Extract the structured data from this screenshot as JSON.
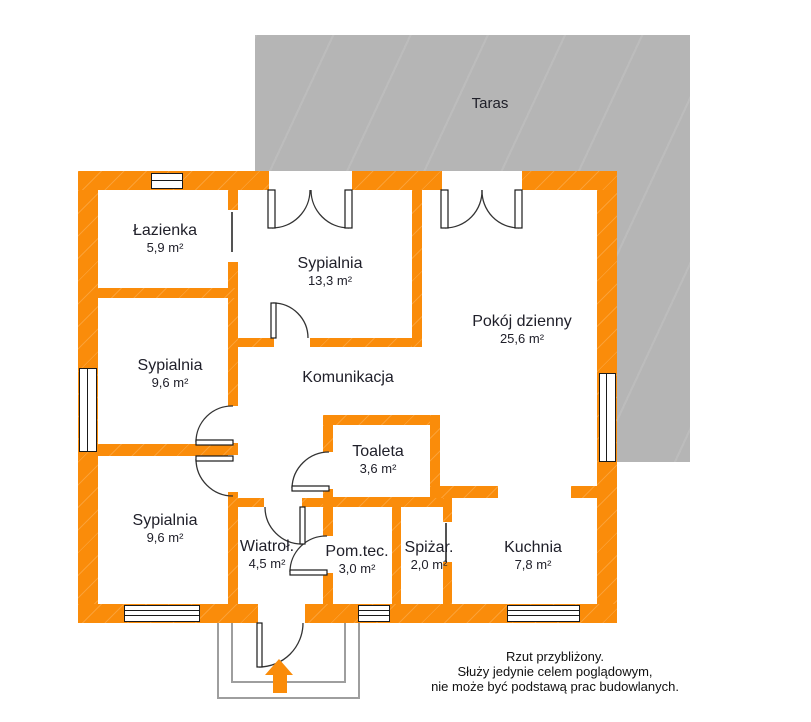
{
  "terrace": {
    "label": "Taras"
  },
  "rooms": [
    {
      "id": "lazienka",
      "name": "Łazienka",
      "area": "5,9 m²",
      "x": 165,
      "y": 222
    },
    {
      "id": "sypialnia-1",
      "name": "Sypialnia",
      "area": "13,3 m²",
      "x": 330,
      "y": 255
    },
    {
      "id": "pokoj-dzienny",
      "name": "Pokój dzienny",
      "area": "25,6 m²",
      "x": 522,
      "y": 313
    },
    {
      "id": "sypialnia-2",
      "name": "Sypialnia",
      "area": "9,6 m²",
      "x": 170,
      "y": 357
    },
    {
      "id": "komunikacja",
      "name": "Komunikacja",
      "area": "",
      "x": 348,
      "y": 369
    },
    {
      "id": "toaleta",
      "name": "Toaleta",
      "area": "3,6 m²",
      "x": 378,
      "y": 443
    },
    {
      "id": "sypialnia-3",
      "name": "Sypialnia",
      "area": "9,6 m²",
      "x": 165,
      "y": 512
    },
    {
      "id": "wiatrolap",
      "name": "Wiatroł.",
      "area": "4,5 m²",
      "x": 267,
      "y": 538
    },
    {
      "id": "pom-tec",
      "name": "Pom.tec.",
      "area": "3,0 m²",
      "x": 357,
      "y": 543
    },
    {
      "id": "spizarnia",
      "name": "Spiżar.",
      "area": "2,0 m²",
      "x": 429,
      "y": 539
    },
    {
      "id": "kuchnia",
      "name": "Kuchnia",
      "area": "7,8 m²",
      "x": 533,
      "y": 539
    }
  ],
  "disclaimer": {
    "lines": [
      "Rzut przybliżony.",
      "Służy jedynie celem poglądowym,",
      "nie może być podstawą prac budowlanych."
    ]
  },
  "colors": {
    "wall": "#fa8c0a",
    "terrace": "#b5b5b5",
    "text": "#20202a",
    "porch_outline": "#9e9e9e"
  }
}
